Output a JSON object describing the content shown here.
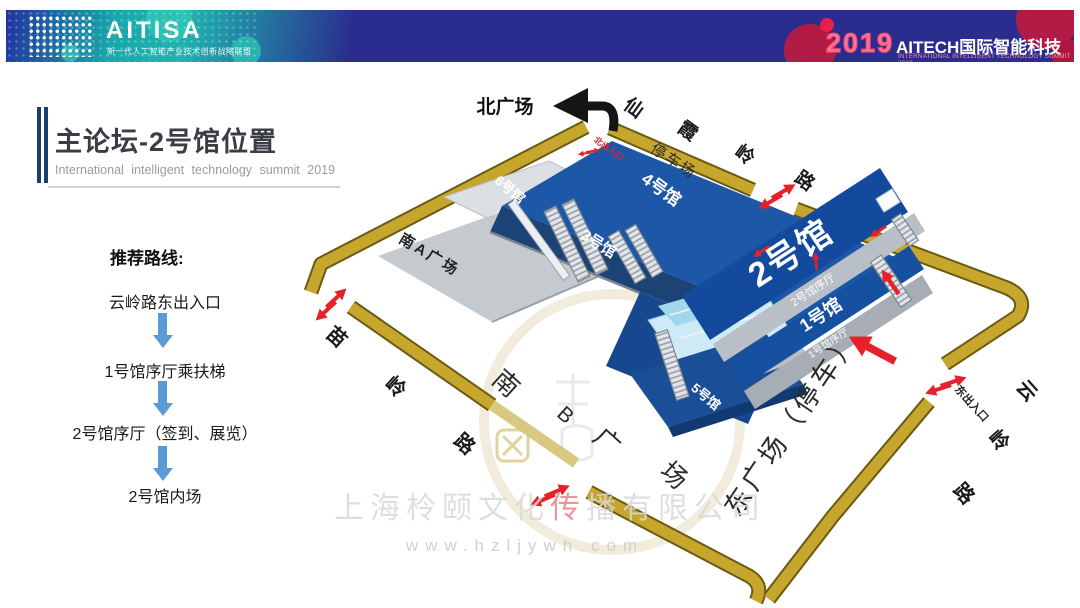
{
  "header": {
    "aitisa": {
      "name": "AITISA",
      "subtitle": "新一代人工智能产业技术创新战略联盟"
    },
    "summit": {
      "year": "2019",
      "title": "AITECH国际智能科技峰会",
      "subtitle": "INTERNATIONAL INTELLIGENT TECHNOLOGY SUMMIT 2019"
    }
  },
  "title": {
    "main": "主论坛-2号馆位置",
    "subtitle": "International intelligent technology summit 2019"
  },
  "route": {
    "heading": "推荐路线:",
    "steps": [
      "云岭路东出入口",
      "1号馆序厅乘扶梯",
      "2号馆序厅（签到、展览）",
      "2号馆内场"
    ]
  },
  "map": {
    "plazas": {
      "north": "北广场",
      "south_a": "南A广场",
      "south_b": [
        "南",
        "B",
        "广",
        "场"
      ],
      "east": "东广场（停车）",
      "parking": "停车场"
    },
    "roads": {
      "north": [
        "仙",
        "霞",
        "岭",
        "路"
      ],
      "east": [
        "云",
        "岭",
        "路"
      ],
      "west": [
        "苗",
        "岭",
        "路"
      ]
    },
    "gates": {
      "north": "北出入口",
      "east": "东出入口"
    },
    "halls": {
      "h1": "1号馆",
      "h2": "2号馆",
      "h3": "3号馆",
      "h4": "4号馆",
      "h5": "5号馆",
      "h6": "6号馆",
      "lobby1": "1号馆序厅",
      "lobby2": "2号馆序厅"
    },
    "colors": {
      "road_gold": "#c7a62e",
      "building_blue": "#1d58a8",
      "deck_gray": "#c5cacf",
      "arrow_red": "#e62129",
      "route_arrow_blue": "#5b9bd5"
    }
  },
  "watermark": {
    "company_pre": "上海柃颐文化",
    "company_mid": "传",
    "company_post": "播有限公司",
    "url": "www.hzljywh.com"
  }
}
